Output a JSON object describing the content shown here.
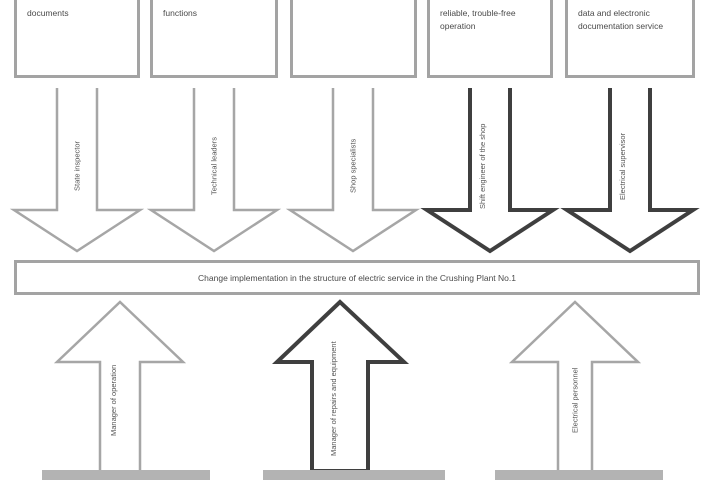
{
  "diagram": {
    "title": "Change implementation diagram",
    "top_boxes": [
      {
        "label": "documents"
      },
      {
        "label": "functions"
      },
      {
        "label": ""
      },
      {
        "label": "reliable, trouble-free operation"
      },
      {
        "label": "data and electronic documentation service"
      }
    ],
    "down_arrows": [
      {
        "label": "State inspector",
        "style": "thin"
      },
      {
        "label": "Technical leaders",
        "style": "thin"
      },
      {
        "label": "Shop specialists",
        "style": "thin"
      },
      {
        "label": "Shift engineer of the shop",
        "style": "bold"
      },
      {
        "label": "Electrical supervisor",
        "style": "bold"
      }
    ],
    "central_box": {
      "label": "Change implementation in the structure of electric service in the Crushing Plant No.1"
    },
    "up_arrows": [
      {
        "label": "Manager of operation",
        "style": "thin"
      },
      {
        "label": "Manager of repairs and equipment",
        "style": "bold"
      },
      {
        "label": "Electrical personnel",
        "style": "thin"
      }
    ],
    "colors": {
      "thin_border": "#a3a3a3",
      "bold_border": "#3f3f3f",
      "text": "#4a4a4a",
      "bottom_bar": "#b3b3b3"
    }
  }
}
